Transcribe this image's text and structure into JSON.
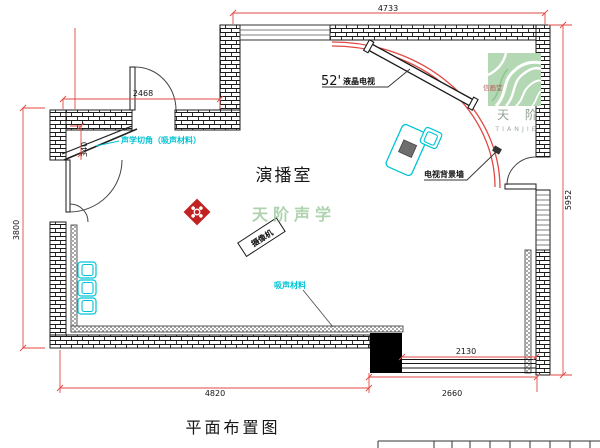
{
  "drawing": {
    "title": "平面布置图",
    "room_label": "演播室",
    "watermark": "天阶声学"
  },
  "labels": {
    "tv_size": "52'",
    "tv_name": "液晶电视",
    "tv_wall": "电视背景墙",
    "acoustic_corner": "声学切角（吸声材料）",
    "acoustic_material": "吸声材料",
    "camera": "摄像机"
  },
  "dimensions": {
    "top": "4733",
    "entry": "2468",
    "corner_cut": "340",
    "left": "3800",
    "right": "5952",
    "bottom_left": "4820",
    "bottom_right": "2660",
    "bottom_inner": "2130"
  },
  "logo": {
    "seal": "信画堂",
    "name_cn": "天 阶",
    "name_en": "TIANJIE"
  },
  "colors": {
    "dimension_red": "#e04a44",
    "annotation_cyan": "#00c4d4",
    "watermark_green": "#9cc89c",
    "logo_green": "#b4d8b4",
    "ornament_red": "#c32222",
    "line_black": "#1a1a1a"
  }
}
